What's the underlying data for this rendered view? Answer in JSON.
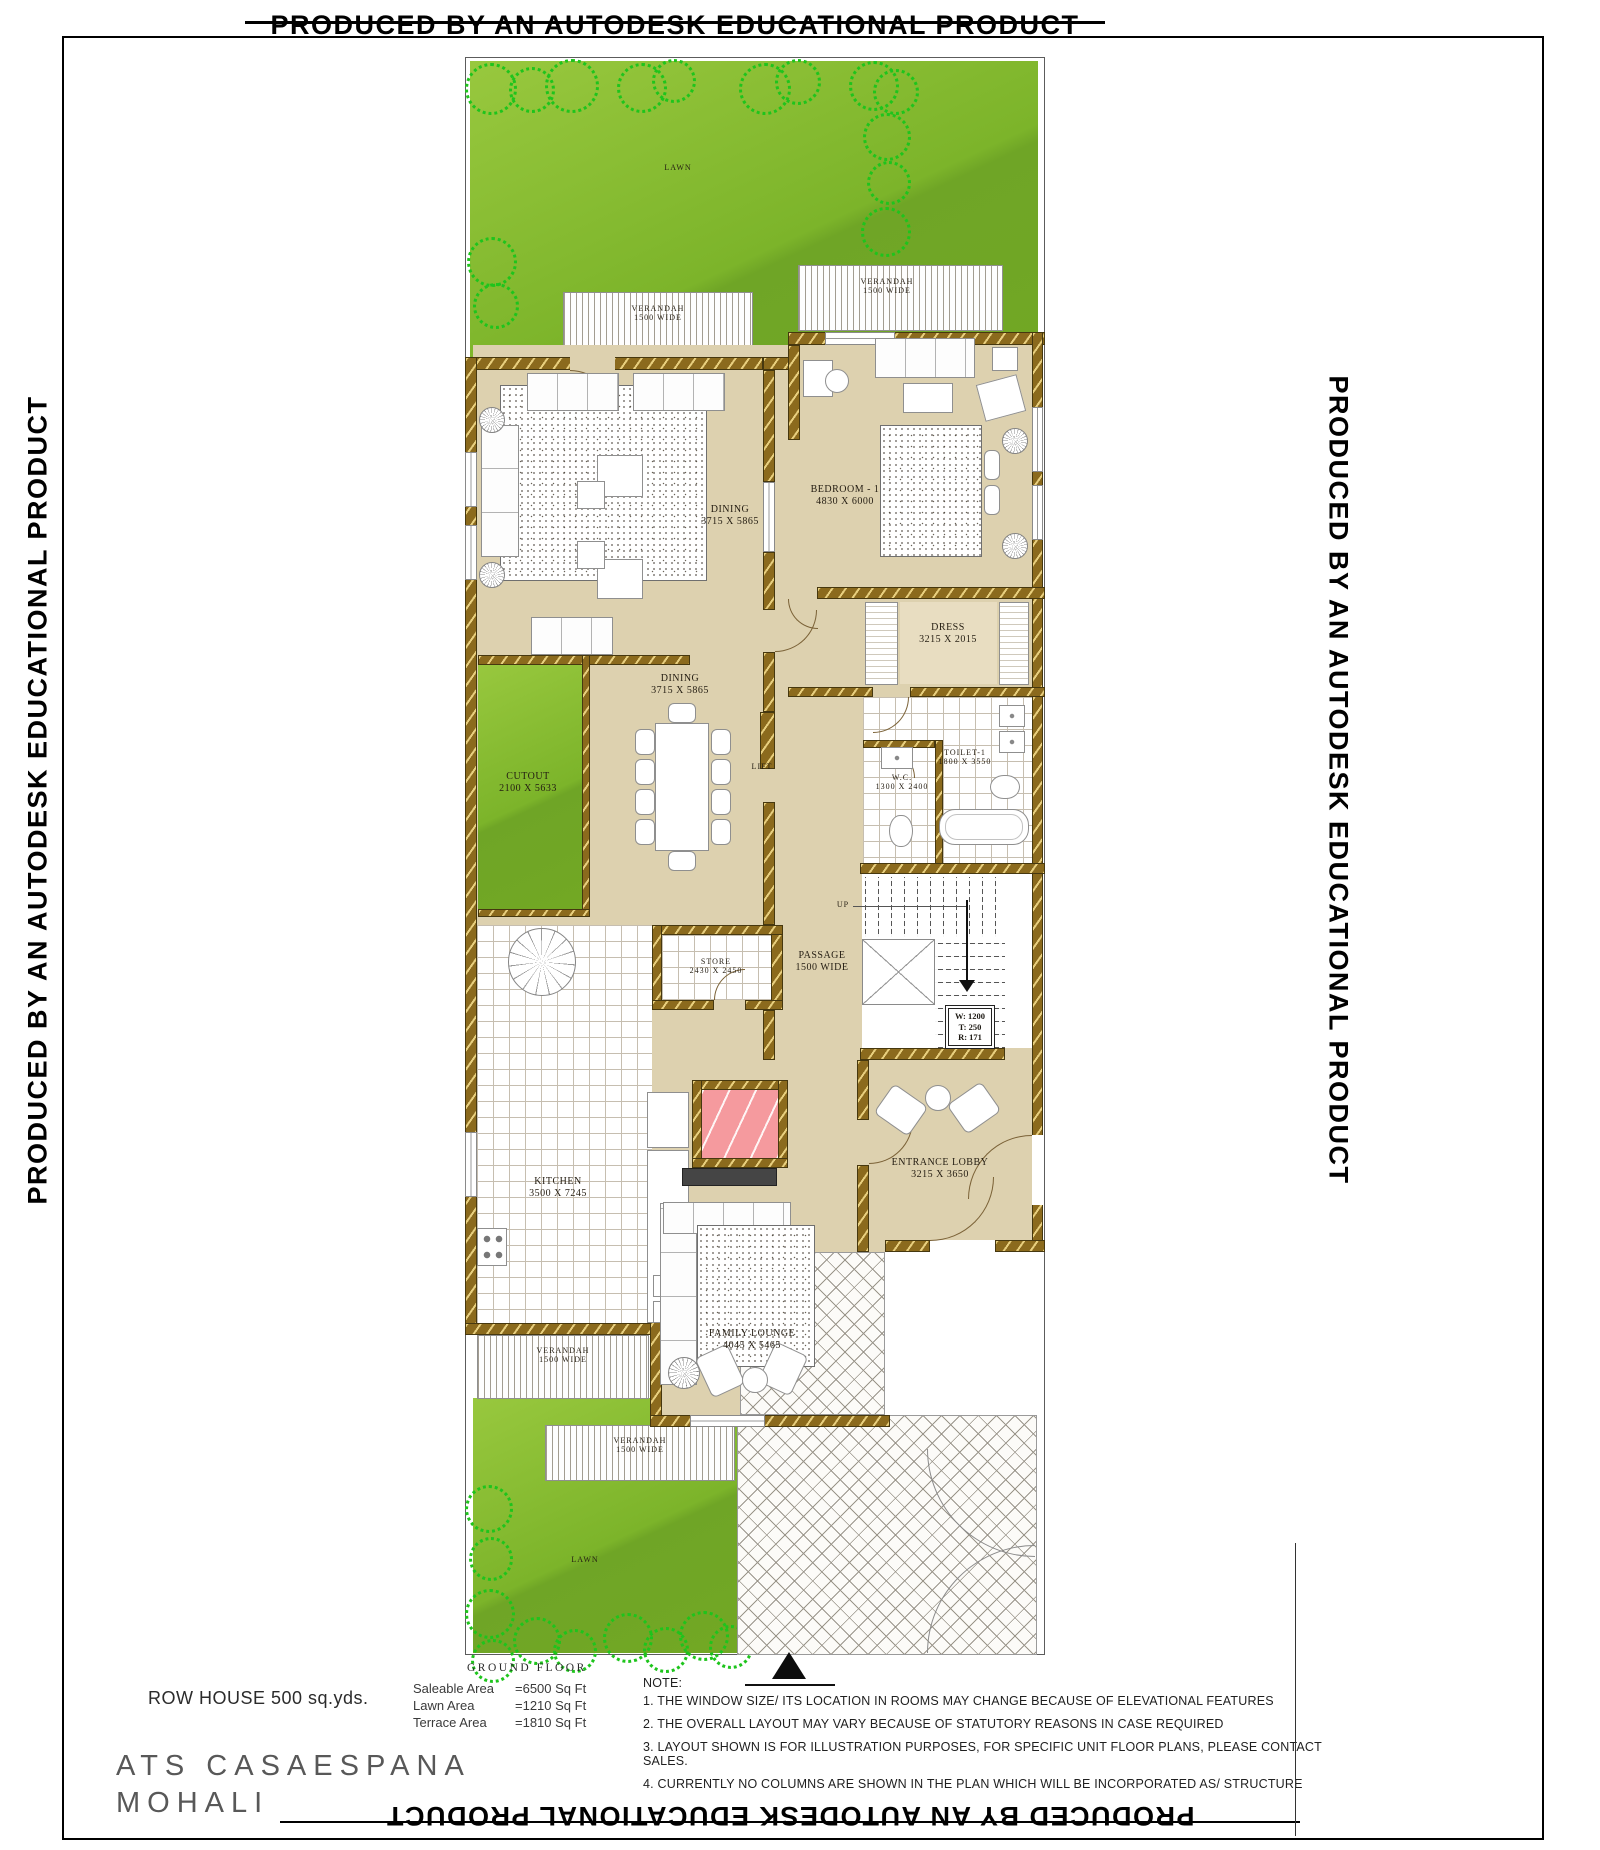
{
  "stamp": {
    "text": "PRODUCED BY AN AUTODESK EDUCATIONAL PRODUCT"
  },
  "plan": {
    "lawn_top": {
      "name": "LAWN"
    },
    "verandah_tl": {
      "name": "VERANDAH",
      "dims": "1500 WIDE"
    },
    "verandah_tr": {
      "name": "VERANDAH",
      "dims": "1500 WIDE"
    },
    "living": {
      "name": "DINING",
      "dims": "3715 X 5865"
    },
    "bedroom1": {
      "name": "BEDROOM - 1",
      "dims": "4830 X 6000"
    },
    "dress": {
      "name": "DRESS",
      "dims": "3215 X 2015"
    },
    "toilet1": {
      "name": "TOILET-1",
      "dims": "1800 X 3550"
    },
    "wc": {
      "name": "W.C.",
      "dims": "1300 X 2400"
    },
    "cutout": {
      "name": "CUTOUT",
      "dims": "2100 X 5633"
    },
    "dining": {
      "name": "DINING",
      "dims": "3715 X 5865"
    },
    "store": {
      "name": "STORE",
      "dims": "2430 X 2450"
    },
    "passage": {
      "name": "PASSAGE",
      "dims": "1500 WIDE"
    },
    "lift": {
      "name": "LIFT"
    },
    "kitchen": {
      "name": "KITCHEN",
      "dims": "3500 X 7245"
    },
    "family_lounge": {
      "name": "FAMILY LOUNGE",
      "dims": "4045 X 5465"
    },
    "entrance_lobby": {
      "name": "ENTRANCE LOBBY",
      "dims": "3215 X 3650"
    },
    "verandah_bl": {
      "name": "VERANDAH",
      "dims": "1500 WIDE"
    },
    "verandah_bc": {
      "name": "VERANDAH",
      "dims": "1500 WIDE"
    },
    "lawn_bottom": {
      "name": "LAWN"
    },
    "stair": {
      "up": "UP",
      "width": "W: 1200",
      "tread": "T: 250",
      "riser": "R: 171"
    }
  },
  "floor_label": "GROUND FLOOR",
  "title_block": {
    "title": "ROW HOUSE 500 sq.yds.",
    "areas": [
      {
        "label": "Saleable Area",
        "value": "=6500 Sq Ft"
      },
      {
        "label": "Lawn Area",
        "value": "=1210 Sq Ft"
      },
      {
        "label": "Terrace Area",
        "value": "=1810 Sq Ft"
      }
    ],
    "note_heading": "NOTE:",
    "notes": [
      "1. THE WINDOW SIZE/ ITS LOCATION IN ROOMS MAY CHANGE BECAUSE OF ELEVATIONAL FEATURES",
      "2. THE OVERALL LAYOUT MAY VARY BECAUSE OF STATUTORY REASONS IN CASE REQUIRED",
      "3. LAYOUT SHOWN IS FOR ILLUSTRATION PURPOSES, FOR SPECIFIC UNIT FLOOR PLANS, PLEASE CONTACT SALES.",
      "4. CURRENTLY NO COLUMNS ARE SHOWN IN THE PLAN WHICH WILL BE INCORPORATED AS/ STRUCTURE"
    ],
    "project": "ATS CASAESPANA",
    "city": "MOHALI"
  },
  "colors": {
    "wall": "#8b6a1d",
    "lawn": "#7cb42a",
    "floor": "#ddd1af",
    "accent_pink": "#f59a9e",
    "tree": "#1ec41c"
  }
}
